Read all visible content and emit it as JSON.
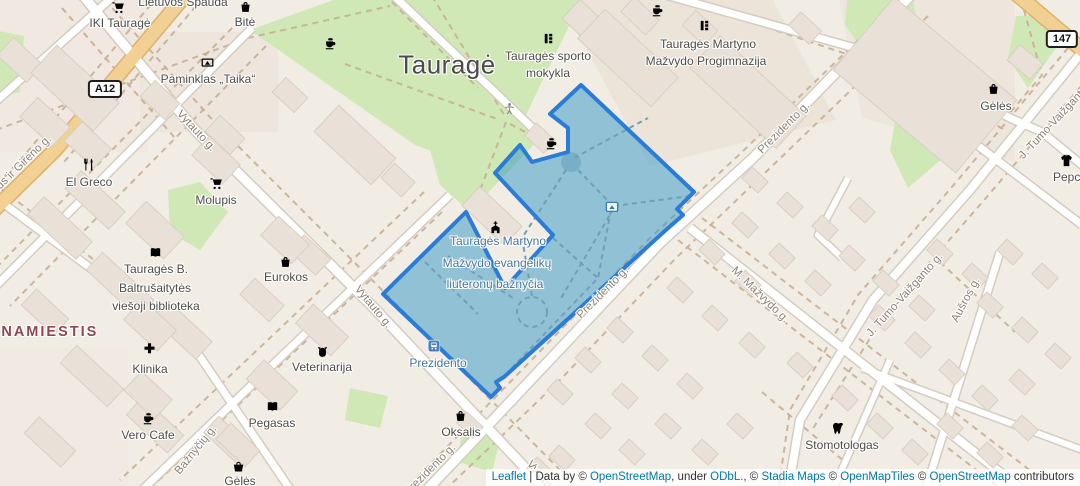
{
  "map": {
    "city_label": "Tauragė",
    "district_label": "ENAMIESTIS",
    "selected_area": {
      "name": "Tauragės Martyno Mažvydo evangelikų liuteronų bažnyčia",
      "fill_color": "#2d96c6",
      "fill_opacity": 0.5,
      "border_color": "#2b7cd6"
    },
    "road_shields": [
      {
        "name": "road-shield-a12",
        "ref": "A12",
        "x": 105,
        "y": 89
      },
      {
        "name": "road-shield-147",
        "ref": "147",
        "x": 1062,
        "y": 39
      }
    ],
    "labels": [
      {
        "name": "poi-label-lietuvos-spauda",
        "text": "Lietuvos Spauda",
        "x": 183,
        "y": 2,
        "rot": 0,
        "cls": "poi"
      },
      {
        "name": "poi-label-iki-taurage",
        "text": "IKI Tauragė",
        "x": 120,
        "y": 23,
        "rot": 0,
        "cls": "poi"
      },
      {
        "name": "poi-label-bite",
        "text": "Bitė",
        "x": 245,
        "y": 22,
        "rot": 0,
        "cls": "poi"
      },
      {
        "name": "poi-label-paminklas-taika",
        "text": "Paminklas „Taika“",
        "x": 208,
        "y": 79,
        "rot": 0,
        "cls": "poi"
      },
      {
        "name": "poi-label-sporto-mokykla-1",
        "text": "Tauragės sporto",
        "x": 548,
        "y": 56,
        "rot": 0,
        "cls": "poi"
      },
      {
        "name": "poi-label-sporto-mokykla-2",
        "text": "mokykla",
        "x": 548,
        "y": 73,
        "rot": 0,
        "cls": "poi"
      },
      {
        "name": "poi-label-progimnazija-1",
        "text": "Tauragės Martyno",
        "x": 708,
        "y": 44,
        "rot": 0,
        "cls": "poi"
      },
      {
        "name": "poi-label-progimnazija-2",
        "text": "Mažvydo Progimnazija",
        "x": 706,
        "y": 61,
        "rot": 0,
        "cls": "poi"
      },
      {
        "name": "poi-label-geles-top",
        "text": "Gėlės",
        "x": 996,
        "y": 106,
        "rot": 0,
        "cls": "poi"
      },
      {
        "name": "poi-label-pepco",
        "text": "Pepco",
        "x": 1070,
        "y": 177,
        "rot": 0,
        "cls": "poi"
      },
      {
        "name": "poi-label-el-greco",
        "text": "El Greco",
        "x": 89,
        "y": 182,
        "rot": 0,
        "cls": "poi"
      },
      {
        "name": "poi-label-molupis",
        "text": "Molupis",
        "x": 216,
        "y": 200,
        "rot": 0,
        "cls": "poi"
      },
      {
        "name": "poi-label-biblioteka-1",
        "text": "Tauragės B.",
        "x": 156,
        "y": 269,
        "rot": 0,
        "cls": "poi"
      },
      {
        "name": "poi-label-biblioteka-2",
        "text": "Baltrušaitytės",
        "x": 155,
        "y": 288,
        "rot": 0,
        "cls": "poi"
      },
      {
        "name": "poi-label-biblioteka-3",
        "text": "viešoji biblioteka",
        "x": 156,
        "y": 306,
        "rot": 0,
        "cls": "poi"
      },
      {
        "name": "poi-label-eurokos",
        "text": "Eurokos",
        "x": 286,
        "y": 277,
        "rot": 0,
        "cls": "poi"
      },
      {
        "name": "poi-label-klinika",
        "text": "Klinika",
        "x": 150,
        "y": 369,
        "rot": 0,
        "cls": "poi"
      },
      {
        "name": "poi-label-vero-cafe",
        "text": "Vero Cafe",
        "x": 148,
        "y": 435,
        "rot": 0,
        "cls": "poi"
      },
      {
        "name": "poi-label-veterinarija",
        "text": "Veterinarija",
        "x": 322,
        "y": 367,
        "rot": 0,
        "cls": "poi"
      },
      {
        "name": "poi-label-pegasas",
        "text": "Pegasas",
        "x": 272,
        "y": 423,
        "rot": 0,
        "cls": "poi"
      },
      {
        "name": "poi-label-geles-bottom",
        "text": "Gėlės",
        "x": 240,
        "y": 481,
        "rot": 0,
        "cls": "poi"
      },
      {
        "name": "poi-label-oksalis",
        "text": "Oksalis",
        "x": 461,
        "y": 432,
        "rot": 0,
        "cls": "poi"
      },
      {
        "name": "poi-label-stomotologas",
        "text": "Stomotologas",
        "x": 842,
        "y": 445,
        "rot": 0,
        "cls": "poi"
      },
      {
        "name": "selected-area-label-1",
        "text": "Tauragės Martyno",
        "x": 498,
        "y": 241,
        "rot": 0,
        "cls": "blue"
      },
      {
        "name": "selected-area-label-2",
        "text": "Mažvydo evangelikų",
        "x": 497,
        "y": 263,
        "rot": 0,
        "cls": "blue"
      },
      {
        "name": "selected-area-label-3",
        "text": "liuteronų bažnyčia",
        "x": 495,
        "y": 284,
        "rot": 0,
        "cls": "blue"
      },
      {
        "name": "bus-stop-label-prezidento",
        "text": "Prezidento",
        "x": 438,
        "y": 363,
        "rot": 0,
        "cls": "blue"
      },
      {
        "name": "street-label-vytauto-1",
        "text": "Vytauto g.",
        "x": 196,
        "y": 131,
        "rot": 47,
        "cls": "street"
      },
      {
        "name": "street-label-vytauto-2",
        "text": "Vytauto g.",
        "x": 373,
        "y": 307,
        "rot": 50,
        "cls": "street"
      },
      {
        "name": "street-label-vytauto-3",
        "text": "Vytauto g.",
        "x": 545,
        "y": 482,
        "rot": 50,
        "cls": "street"
      },
      {
        "name": "street-label-prezidento-1",
        "text": "Prezidento g.",
        "x": 784,
        "y": 128,
        "rot": -45,
        "cls": "street"
      },
      {
        "name": "street-label-prezidento-2",
        "text": "Prezidento g.",
        "x": 603,
        "y": 293,
        "rot": -45,
        "cls": "street"
      },
      {
        "name": "street-label-prezidento-3",
        "text": "Prezidento g.",
        "x": 430,
        "y": 470,
        "rot": -45,
        "cls": "street"
      },
      {
        "name": "street-label-mazvydo",
        "text": "M. Mažvydo g.",
        "x": 760,
        "y": 295,
        "rot": 44,
        "cls": "street"
      },
      {
        "name": "street-label-tumo-1",
        "text": "J. Tumo-Vaižganto g.",
        "x": 1058,
        "y": 118,
        "rot": -47,
        "cls": "street"
      },
      {
        "name": "street-label-tumo-2",
        "text": "J. Tumo-Vaižganto g.",
        "x": 905,
        "y": 295,
        "rot": -48,
        "cls": "street"
      },
      {
        "name": "street-label-ausros",
        "text": "Aušros g.",
        "x": 966,
        "y": 300,
        "rot": -62,
        "cls": "street"
      },
      {
        "name": "street-label-baznyciu",
        "text": "Bažnyčių g.",
        "x": 196,
        "y": 450,
        "rot": -51,
        "cls": "street"
      },
      {
        "name": "street-label-gireno",
        "text": "Dariaus ir Girėno g.",
        "x": 14,
        "y": 172,
        "rot": -44,
        "cls": "street"
      }
    ],
    "icons": [
      {
        "name": "shopping-cart-icon-iki",
        "type": "cart",
        "x": 118,
        "y": 7
      },
      {
        "name": "shopping-bag-icon-bite",
        "type": "bag",
        "x": 245,
        "y": 6
      },
      {
        "name": "coffee-icon-1",
        "type": "coffee",
        "x": 330,
        "y": 43
      },
      {
        "name": "monument-icon-paminklas",
        "type": "monument",
        "x": 207,
        "y": 62
      },
      {
        "name": "school-icon-sporto",
        "type": "school",
        "x": 548,
        "y": 38
      },
      {
        "name": "coffee-icon-2",
        "type": "coffee",
        "x": 657,
        "y": 10
      },
      {
        "name": "school-icon-progimnazija",
        "type": "school",
        "x": 704,
        "y": 25
      },
      {
        "name": "shopping-bag-icon-geles-top",
        "type": "bag",
        "x": 993,
        "y": 88
      },
      {
        "name": "clothing-icon-pepco",
        "type": "shirt",
        "x": 1066,
        "y": 160
      },
      {
        "name": "restaurant-icon-el-greco",
        "type": "restaurant",
        "x": 88,
        "y": 164
      },
      {
        "name": "shopping-cart-icon-molupis",
        "type": "cart",
        "x": 216,
        "y": 183
      },
      {
        "name": "book-icon-biblioteka",
        "type": "book",
        "x": 155,
        "y": 252
      },
      {
        "name": "shopping-bag-icon-eurokos",
        "type": "bag",
        "x": 285,
        "y": 261
      },
      {
        "name": "clinic-cross-icon",
        "type": "cross",
        "x": 149,
        "y": 348
      },
      {
        "name": "coffee-icon-vero",
        "type": "coffee",
        "x": 148,
        "y": 418
      },
      {
        "name": "pet-icon-veterinarija",
        "type": "paw",
        "x": 322,
        "y": 352
      },
      {
        "name": "book-icon-pegasas",
        "type": "book",
        "x": 272,
        "y": 406
      },
      {
        "name": "basket-icon-geles-bottom",
        "type": "basket",
        "x": 238,
        "y": 466
      },
      {
        "name": "shopping-bag-icon-oksalis",
        "type": "bag",
        "x": 460,
        "y": 415
      },
      {
        "name": "tooth-icon-stomotologas",
        "type": "tooth",
        "x": 838,
        "y": 428
      },
      {
        "name": "church-icon",
        "type": "church",
        "x": 495,
        "y": 227
      },
      {
        "name": "playground-icon",
        "type": "playground",
        "x": 509,
        "y": 108
      },
      {
        "name": "coffee-icon-3",
        "type": "coffee",
        "x": 551,
        "y": 143
      },
      {
        "name": "attraction-icon",
        "type": "attraction",
        "x": 612,
        "y": 207
      },
      {
        "name": "bus-stop-icon",
        "type": "bus",
        "x": 434,
        "y": 346
      }
    ]
  },
  "attribution": {
    "parts": [
      {
        "text": "Leaflet",
        "link": true
      },
      {
        "text": " | Data by © ",
        "link": false
      },
      {
        "text": "OpenStreetMap",
        "link": true
      },
      {
        "text": ", under ",
        "link": false
      },
      {
        "text": "ODbL.",
        "link": true
      },
      {
        "text": ", © ",
        "link": false
      },
      {
        "text": "Stadia Maps",
        "link": true
      },
      {
        "text": " © ",
        "link": false
      },
      {
        "text": "OpenMapTiles",
        "link": true
      },
      {
        "text": " © ",
        "link": false
      },
      {
        "text": "OpenStreetMap",
        "link": true
      },
      {
        "text": " contributors",
        "link": false
      }
    ]
  }
}
